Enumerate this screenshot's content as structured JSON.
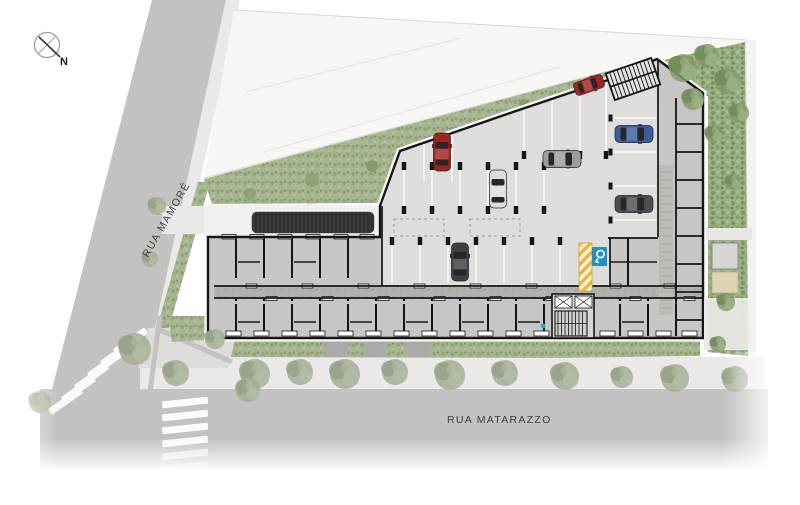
{
  "page": {
    "background_color": "#ffffff"
  },
  "compass": {
    "label": "N"
  },
  "streets": {
    "left_label": "RUA MAMORÉ",
    "bottom_label": "RUA MATARAZZO"
  },
  "palette": {
    "street": "#c2c2c0",
    "sidewalk": "#e9e9e7",
    "neighbor_lot": "#f6f6f5",
    "vegetation_base": "#a6b490",
    "garden_base": "#9cb183",
    "building_rooms": "#c6c6c4",
    "parking_floor": "#dedddb",
    "corridor": "#b2b0ab",
    "walls": "#161616",
    "ramp": "#2d2d2d",
    "safety_strip_yellow": "#e6b93e",
    "accessible_sign_blue": "#1f8fc4",
    "utility_marker_cyan": "#2aa7c8",
    "street_label_text": "#3d3d3d",
    "crosswalk_white": "#ffffff"
  },
  "vehicles": [
    {
      "id": "car-red-large",
      "color": "#9e2320",
      "x": 442,
      "y": 152,
      "angle": 0
    },
    {
      "id": "car-white",
      "color": "#dcdcda",
      "x": 498,
      "y": 189,
      "angle": 0
    },
    {
      "id": "car-silver",
      "color": "#9c9c9a",
      "x": 562,
      "y": 159,
      "angle": 90
    },
    {
      "id": "car-dark",
      "color": "#3f3f41",
      "x": 460,
      "y": 262,
      "angle": 0
    },
    {
      "id": "car-blue",
      "color": "#3d5c9e",
      "x": 634,
      "y": 134,
      "angle": 90
    },
    {
      "id": "car-gray",
      "color": "#4e4e52",
      "x": 634,
      "y": 204,
      "angle": 90
    },
    {
      "id": "car-red-small",
      "color": "#a12420",
      "x": 589,
      "y": 85,
      "angle": 71,
      "scale": 0.8
    }
  ],
  "trees": {
    "sidewalk": [
      {
        "x": 255,
        "y": 374,
        "r": 15
      },
      {
        "x": 300,
        "y": 372,
        "r": 13
      },
      {
        "x": 345,
        "y": 374,
        "r": 15
      },
      {
        "x": 395,
        "y": 372,
        "r": 13
      },
      {
        "x": 450,
        "y": 375,
        "r": 15
      },
      {
        "x": 505,
        "y": 373,
        "r": 13
      },
      {
        "x": 565,
        "y": 376,
        "r": 14
      },
      {
        "x": 622,
        "y": 377,
        "r": 11
      },
      {
        "x": 675,
        "y": 378,
        "r": 14
      },
      {
        "x": 735,
        "y": 379,
        "r": 13
      }
    ],
    "left": [
      {
        "x": 135,
        "y": 349,
        "r": 16
      },
      {
        "x": 176,
        "y": 373,
        "r": 13
      },
      {
        "x": 40,
        "y": 402,
        "r": 11
      },
      {
        "x": 157,
        "y": 206,
        "r": 9
      },
      {
        "x": 150,
        "y": 259,
        "r": 8
      },
      {
        "x": 215,
        "y": 339,
        "r": 10
      },
      {
        "x": 248,
        "y": 390,
        "r": 12
      }
    ],
    "garden": [
      {
        "x": 683,
        "y": 68,
        "r": 14
      },
      {
        "x": 707,
        "y": 56,
        "r": 12
      },
      {
        "x": 728,
        "y": 81,
        "r": 13
      },
      {
        "x": 693,
        "y": 99,
        "r": 11
      },
      {
        "x": 739,
        "y": 113,
        "r": 10
      },
      {
        "x": 714,
        "y": 134,
        "r": 9
      },
      {
        "x": 733,
        "y": 182,
        "r": 8
      },
      {
        "x": 726,
        "y": 302,
        "r": 9
      },
      {
        "x": 718,
        "y": 344,
        "r": 8
      }
    ]
  }
}
